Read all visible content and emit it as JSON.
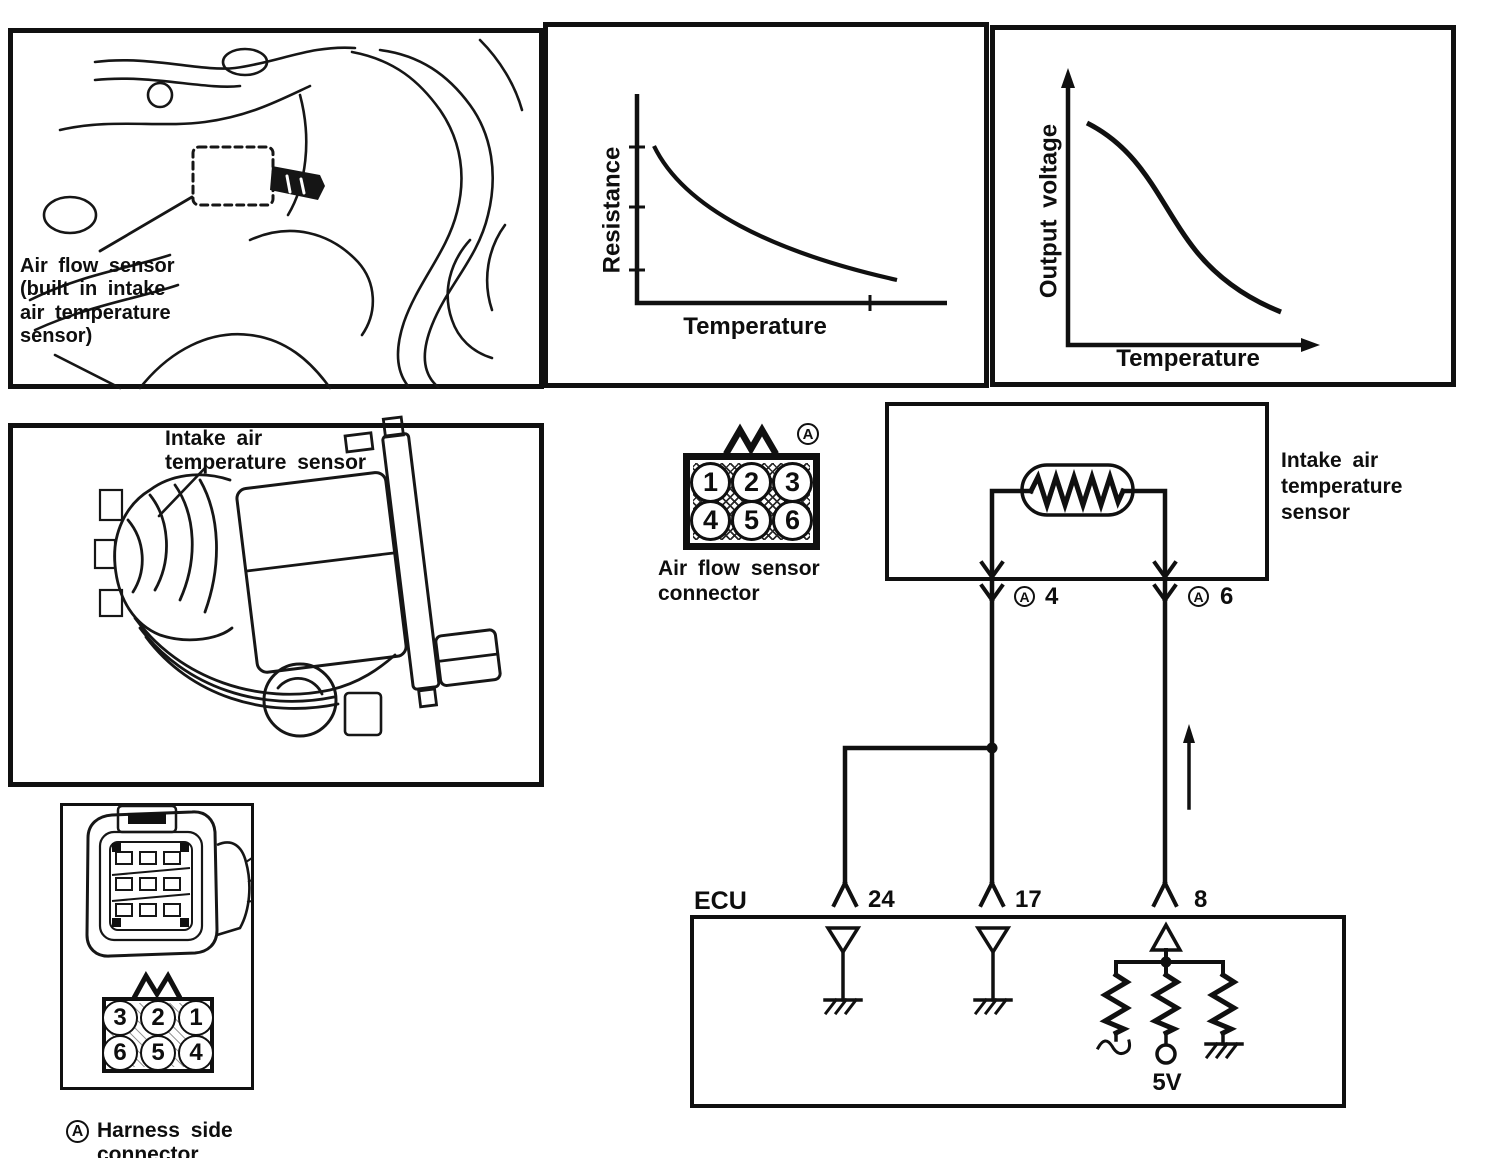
{
  "colors": {
    "ink": "#101010",
    "paper": "#ffffff"
  },
  "engine_panel": {
    "label_lines": [
      "Air flow sensor",
      "(built in intake",
      "air temperature",
      "sensor)"
    ]
  },
  "graphs": {
    "resistance": {
      "ylabel": "Resistance",
      "xlabel": "Temperature"
    },
    "voltage": {
      "ylabel": "Output voltage",
      "xlabel": "Temperature"
    }
  },
  "sensor_panel": {
    "label_lines": [
      "Intake air",
      "temperature sensor"
    ]
  },
  "airflow_connector": {
    "marker": "A",
    "pins": [
      "1",
      "2",
      "3",
      "4",
      "5",
      "6"
    ],
    "label_lines": [
      "Air flow sensor",
      "connector"
    ]
  },
  "harness_connector": {
    "marker": "A",
    "pins": [
      "3",
      "2",
      "1",
      "6",
      "5",
      "4"
    ],
    "label_lines": [
      "Harness side",
      "connector"
    ]
  },
  "circuit": {
    "sensor_label_lines": [
      "Intake air",
      "temperature",
      "sensor"
    ],
    "connectors": [
      {
        "marker": "A",
        "number": "4"
      },
      {
        "marker": "A",
        "number": "6"
      }
    ],
    "ecu_label": "ECU",
    "ecu_pins": [
      "24",
      "17",
      "8"
    ],
    "supply_label": "5V"
  },
  "chart_data": [
    {
      "type": "line",
      "title": "Intake air temperature sensor characteristic",
      "xlabel": "Temperature",
      "ylabel": "Resistance",
      "x": [
        0,
        0.2,
        0.4,
        0.6,
        0.8,
        1.0
      ],
      "series": [
        {
          "name": "Resistance vs temperature (NTC thermistor)",
          "values": [
            1.0,
            0.62,
            0.42,
            0.28,
            0.18,
            0.12
          ]
        }
      ],
      "axis_ticks": {
        "y_unlabeled_ticks": 3,
        "x_unlabeled_ticks": 1
      },
      "grid": false,
      "legend": "none",
      "shape": "monotonically decreasing, concave-up exponential decay"
    },
    {
      "type": "line",
      "title": "Sensor output characteristic",
      "xlabel": "Temperature",
      "ylabel": "Output voltage",
      "x": [
        0,
        0.2,
        0.4,
        0.6,
        0.8,
        1.0
      ],
      "series": [
        {
          "name": "Output voltage vs temperature",
          "values": [
            0.95,
            0.84,
            0.6,
            0.33,
            0.17,
            0.1
          ]
        }
      ],
      "axis_arrows": true,
      "grid": false,
      "legend": "none",
      "shape": "S-shaped monotonically decreasing curve"
    }
  ]
}
